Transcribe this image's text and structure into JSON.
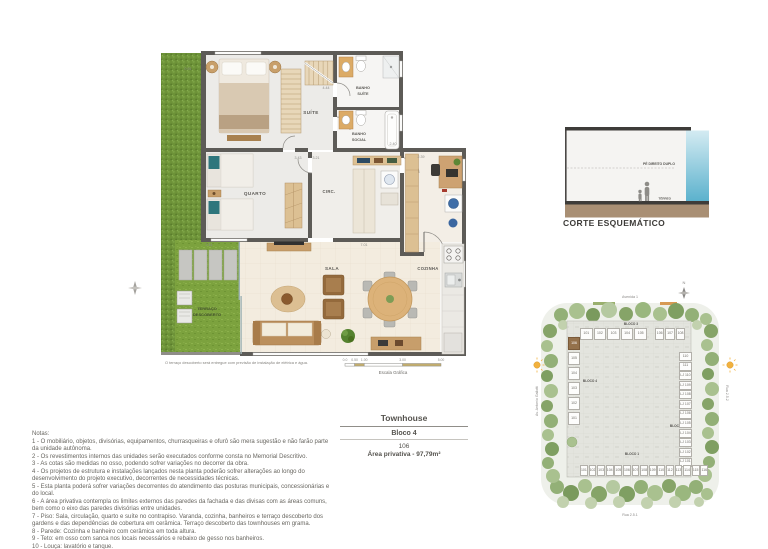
{
  "floor_plan": {
    "rooms": {
      "suite": "SUÍTE",
      "quarto": "QUARTO",
      "circ": "CIRC.",
      "sala": "SALA",
      "cozinha": "COZINHA",
      "banho_suite_l1": "BANHO",
      "banho_suite_l2": "SUÍTE",
      "banho_social_l1": "BANHO",
      "banho_social_l2": "SOCIAL",
      "terraco_l1": "TERRAÇO",
      "terraco_l2": "DESCOBERTO"
    },
    "dims": {
      "d1": "4.44",
      "d2": "3.43",
      "d3": "3.21",
      "d4": "2.40",
      "d5": "2.39",
      "d6": "7.01",
      "d7": "2.41",
      "d8": "0.91"
    },
    "footnote": "O terraço descoberto será entregue com previsão de instalação de elétrica e água.",
    "scale": {
      "title": "Escala Gráfica",
      "t0": "0.0",
      "t1": "0.50",
      "t2": "1.00",
      "t3": "3.00",
      "t4": "5.00"
    }
  },
  "section": {
    "title": "CORTE ESQUEMÁTICO",
    "pe_direito": "PÉ DIREITO DUPLO",
    "terreo": "TÉRREO",
    "sky_color": "#58b0cc",
    "ground_color": "#a98f74"
  },
  "info_table": {
    "unit_type": "Townhouse",
    "block": "Bloco 4",
    "unit_number": "106",
    "area": "Área privativa - 97,79m²"
  },
  "notes": {
    "title": "Notas:",
    "items": [
      "1 - O mobiliário, objetos, divisórias, equipamentos, churrasqueiras e ofurô são mera sugestão e não farão parte da unidade autônoma.",
      "2 - Os revestimentos internos das unidades serão executados conforme consta no Memorial Descritivo.",
      "3 - As cotas são medidas no osso, podendo sofrer variações no decorrer da obra.",
      "4 - Os projetos de estrutura e instalações lançados nesta planta poderão sofrer alterações ao longo do desenvolvimento do projeto executivo, decorrentes de necessidades técnicas.",
      "5 - Esta planta poderá sofrer variações decorrentes do atendimento das posturas municipais, concessionárias e do local.",
      "6 - A área privativa contempla os limites externos das paredes da fachada e das divisas com as áreas comuns, bem como o eixo das paredes divisórias entre unidades.",
      "7 - Piso: Sala, circulação, quarto e suíte no contrapiso. Varanda, cozinha, banheiros e terraço descoberto dos gardens e das dependências de cobertura em cerâmica. Terraço descoberto das townhouses em grama.",
      "8 - Parede: Cozinha e banheiro com cerâmica em toda altura.",
      "9 - Teto: em osso com sanca nos locais necessários e rebaixo de gesso nos banheiros.",
      "10 - Louça: lavatório e tanque.",
      "11 - Ar-condicionado: previsão para instalação de ar-condicionado tipo split, com ponto elétrico e dreno, que deverá ser instalado conforme projeto. A previsão das condensadoras irá variar conforme projeto de fachada."
    ]
  },
  "site_plan": {
    "compass": "N",
    "streets": {
      "top": "Avenida 1",
      "bottom": "Rua 2.5.1",
      "left": "Av. Antonio Gallotti",
      "right": "Rua 2.5.2"
    },
    "blocks": {
      "b1": "BLOCO 1",
      "b2": "BLOCO 2",
      "b3": "BLOCO 3",
      "b4": "BLOCO 4"
    },
    "highlighted_unit": "106",
    "highlight_color": "#94714b",
    "top_units_a": [
      "101",
      "102",
      "103",
      "104",
      "105"
    ],
    "top_units_b": [
      "106",
      "107",
      "108"
    ],
    "left_units": [
      "106",
      "105",
      "104",
      "103",
      "102",
      "101"
    ],
    "right_units": [
      "110",
      "111",
      "LJ 110",
      "LJ 109",
      "LJ 108",
      "LJ 107",
      "LJ 106",
      "LJ 105",
      "LJ 104",
      "LJ 103",
      "LJ 102",
      "LJ 101"
    ],
    "bottom_units": [
      "101",
      "102",
      "103",
      "104",
      "105",
      "106",
      "107",
      "108",
      "109",
      "110",
      "112",
      "113",
      "114",
      "115",
      "116"
    ]
  }
}
